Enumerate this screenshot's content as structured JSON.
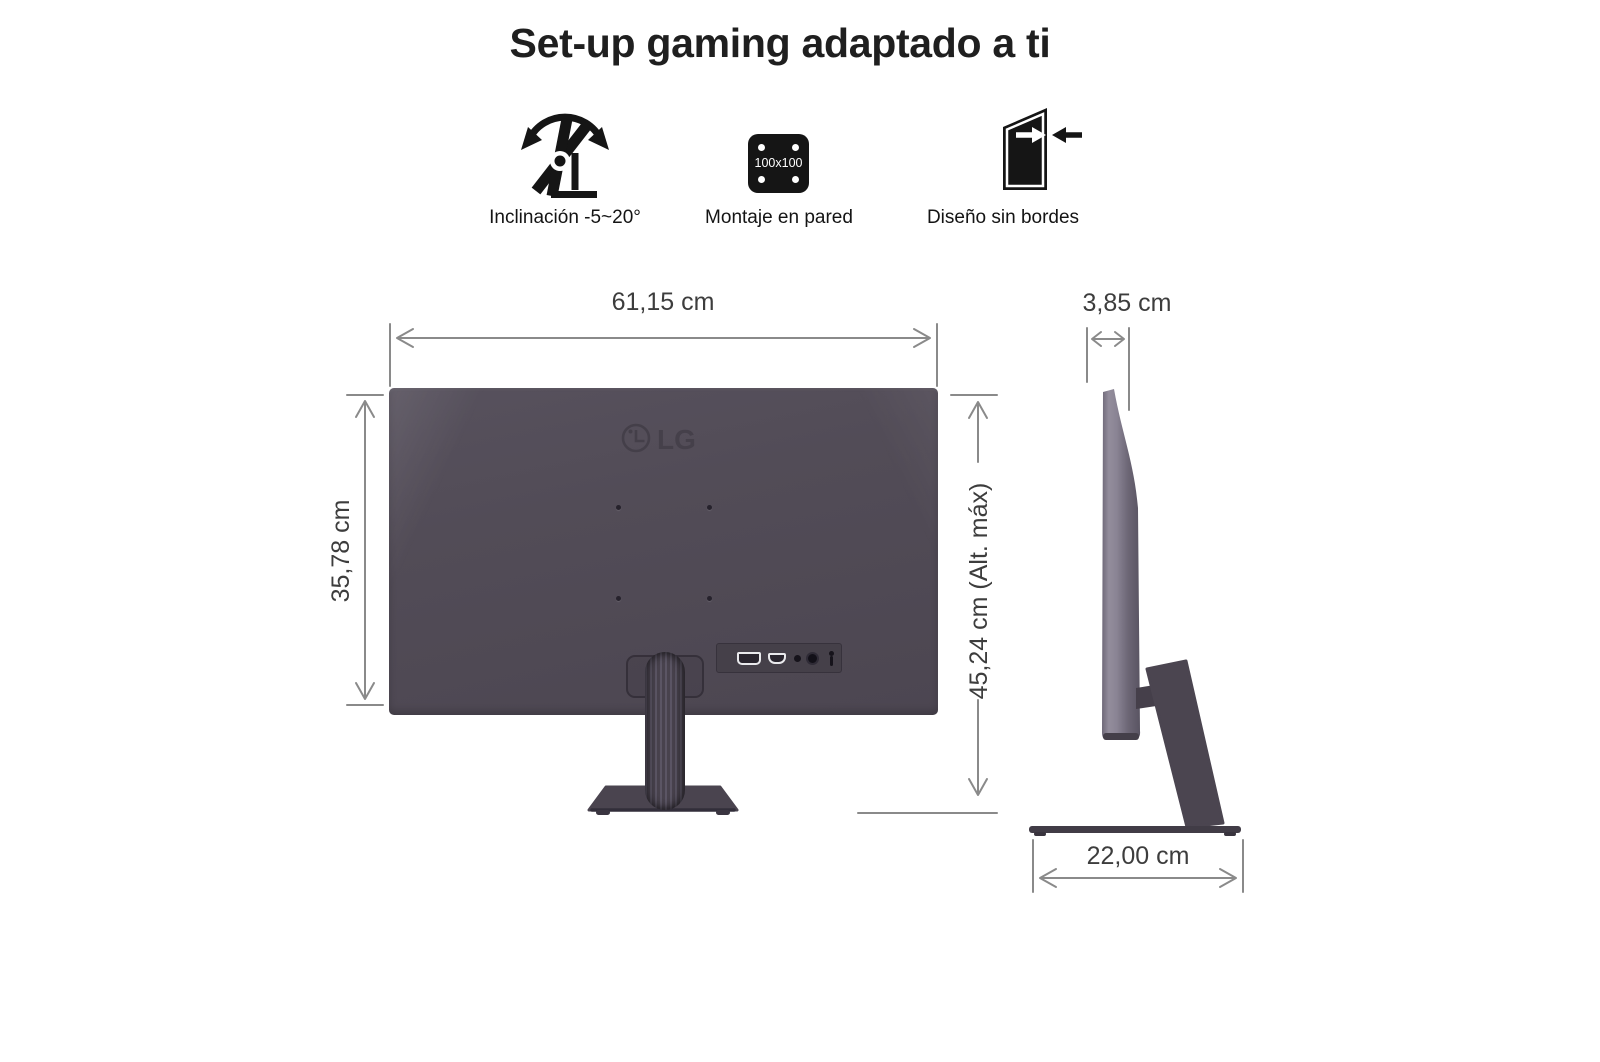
{
  "title": "Set-up gaming adaptado a ti",
  "features": {
    "tilt": {
      "label": "Inclinación -5~20°"
    },
    "wall_mount": {
      "label": "Montaje en pared",
      "vesa": "100x100"
    },
    "borderless": {
      "label": "Diseño sin bordes"
    }
  },
  "rear_view": {
    "brand": "LG",
    "width": "61,15 cm",
    "height": "35,78 cm",
    "max_height": "45,24 cm (Alt. máx)"
  },
  "side_view": {
    "depth": "3,85 cm",
    "base_depth": "22,00 cm"
  },
  "colors": {
    "monitor_body": "#514b56",
    "stand": "#4a444f",
    "side_panel_light": "#8e8896",
    "dimension_line": "#8a8a8a",
    "dimension_text": "#3d3d3d",
    "icon_black": "#151515",
    "title_text": "#1f1f1f"
  }
}
